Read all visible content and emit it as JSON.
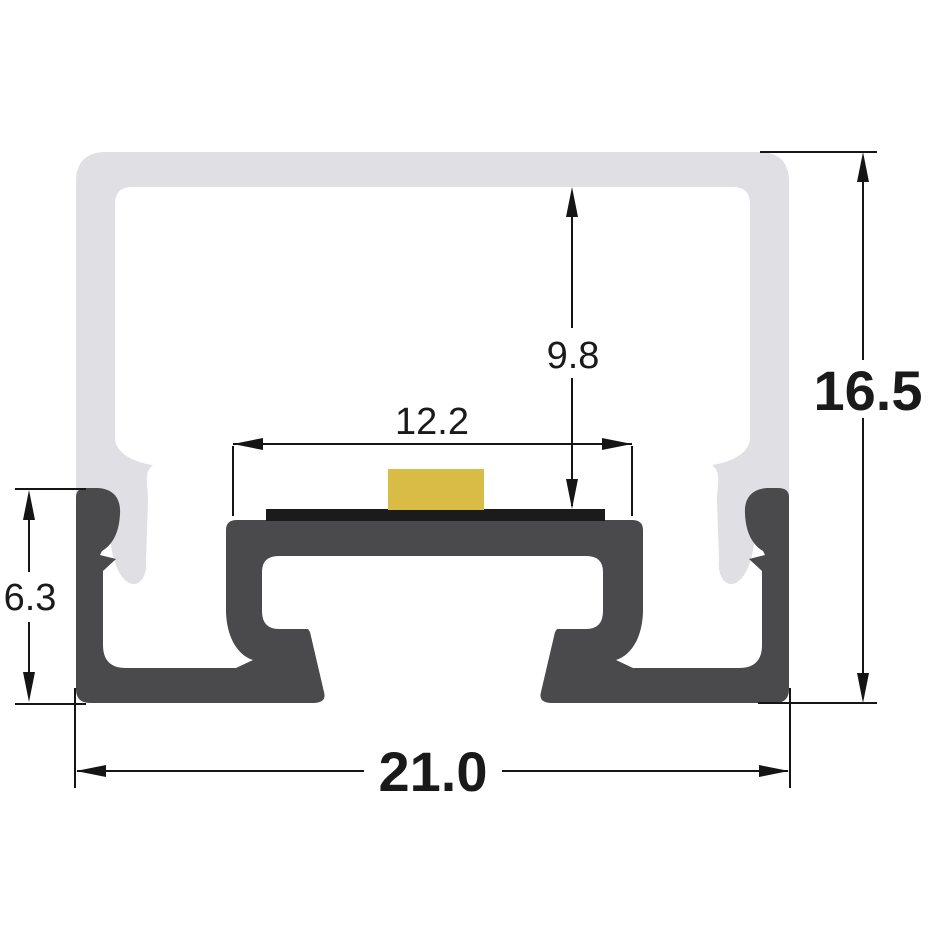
{
  "figure": {
    "dimensions": {
      "overall_width": "21.0",
      "overall_height": "16.5",
      "cavity_depth_to_pcb": "9.8",
      "platform_width": "12.2",
      "base_section_height": "6.3"
    },
    "colors": {
      "background": "#ffffff",
      "diffuser": "#e0e0e4",
      "aluminium": "#4a4a4c",
      "pcb": "#1b1b1b",
      "led": "#d9bc45",
      "lines": "#151515",
      "text": "#1a1a1a"
    },
    "parts": {
      "diffuser": "diffuser-cover",
      "profile": "aluminium-profile",
      "pcb": "pcb-strip",
      "led": "led-chip"
    }
  }
}
